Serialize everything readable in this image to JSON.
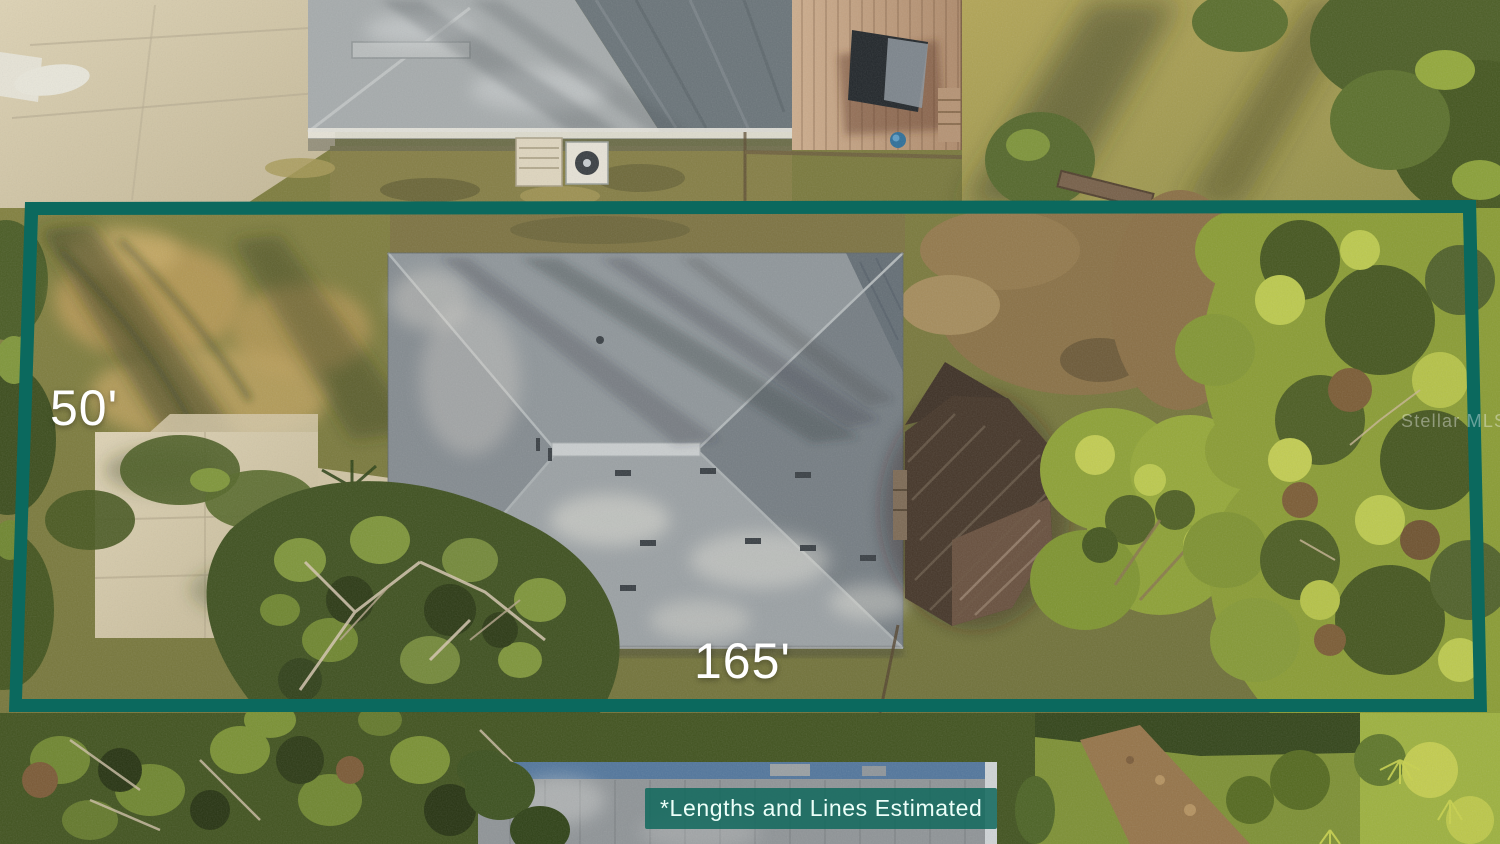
{
  "annotations": {
    "width_label": "50'",
    "length_label": "165'",
    "disclaimer": "*Lengths and Lines Estimated",
    "watermark": "Stellar MLS"
  },
  "colors": {
    "boundary": "#0b695e",
    "banner_bg": "#146a5e",
    "label_text": "#ffffff"
  }
}
